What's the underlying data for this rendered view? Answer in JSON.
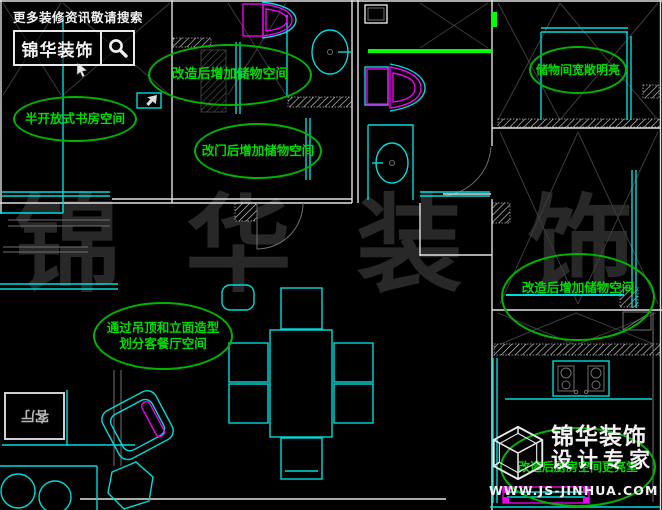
{
  "colors": {
    "background": "#000000",
    "line_white": "#e2e2e2",
    "line_gray": "#707070",
    "line_dark": "#3c3c3c",
    "cyan": "#00dcdc",
    "magenta": "#ee00ee",
    "green_bright": "#00ff00",
    "annotation_green": "#00b400",
    "annotation_text": "#00dc00",
    "watermark": "#282828"
  },
  "header_logo": {
    "tagline": "更多装修资讯敬请搜索",
    "brand": "锦华装饰",
    "search_icon": "magnifier-icon"
  },
  "watermark_text": "锦 华 装 饰",
  "annotations": [
    {
      "label": "改造后增加储物空间"
    },
    {
      "label": "半开放式书房空间"
    },
    {
      "label": "改门后增加储物空间"
    },
    {
      "label": "储物间宽敞明亮"
    },
    {
      "label": "改造后增加储物空间"
    },
    {
      "label": "通过吊顶和立面造型",
      "label2": "划分客餐厅空间"
    },
    {
      "label": "改造后厨房空间更亮堂"
    }
  ],
  "rooms": {
    "living_room": "客厅"
  },
  "footer_logo": {
    "brand": "锦华装饰",
    "subtitle": "设计专家",
    "website": "WWW.JS-JINHUA.COM",
    "icon": "cube-logo-icon"
  }
}
